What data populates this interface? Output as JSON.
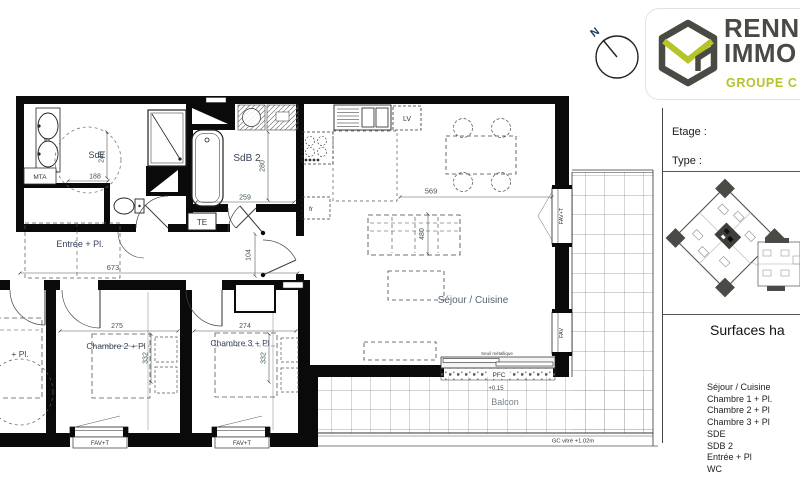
{
  "logo": {
    "line1": "RENN",
    "line2": "IMMO",
    "line3": "GROUPE C"
  },
  "compass": {
    "north": "N"
  },
  "sidebar": {
    "etage": "Etage :",
    "type": "Type :",
    "surfaces": "Surfaces ha",
    "rooms": [
      "Séjour / Cuisine",
      "Chambre 1 + Pl.",
      "Chambre 2 + Pl",
      "Chambre 3 + Pl",
      "SDE",
      "SDB 2",
      "Entrée + Pl",
      "WC"
    ]
  },
  "plan": {
    "sde": {
      "name": "SdE",
      "w": "188",
      "h": "240"
    },
    "sdb2": {
      "name": "SdB 2",
      "w": "259",
      "h": "280"
    },
    "entree": {
      "name": "Entrée + Pl.",
      "w": "673",
      "h": "104"
    },
    "ch1": {
      "name": "+ Pl."
    },
    "ch2": {
      "name": "Chambre 2 + Pl",
      "w": "275",
      "h": "332"
    },
    "ch3": {
      "name": "Chambre 3 + Pl",
      "w": "274",
      "h": "332"
    },
    "sejour": {
      "name": "Séjour / Cuisine",
      "w": "569",
      "h": "480"
    },
    "balcon": {
      "name": "Balcon",
      "level": "+0.15",
      "gc": "GC vitré +1.02m",
      "seuil": "Seuil métallique",
      "pfc": "PFC"
    },
    "tags": {
      "te": "TE",
      "mta": "MTA",
      "mv": "MV",
      "lv": "LV",
      "fr": "fr",
      "favt": "FAV+T",
      "fav": "FAV"
    }
  },
  "colors": {
    "accent": "#b5c427",
    "dark": "#4a4a45",
    "wall": "#0a0a0a"
  }
}
